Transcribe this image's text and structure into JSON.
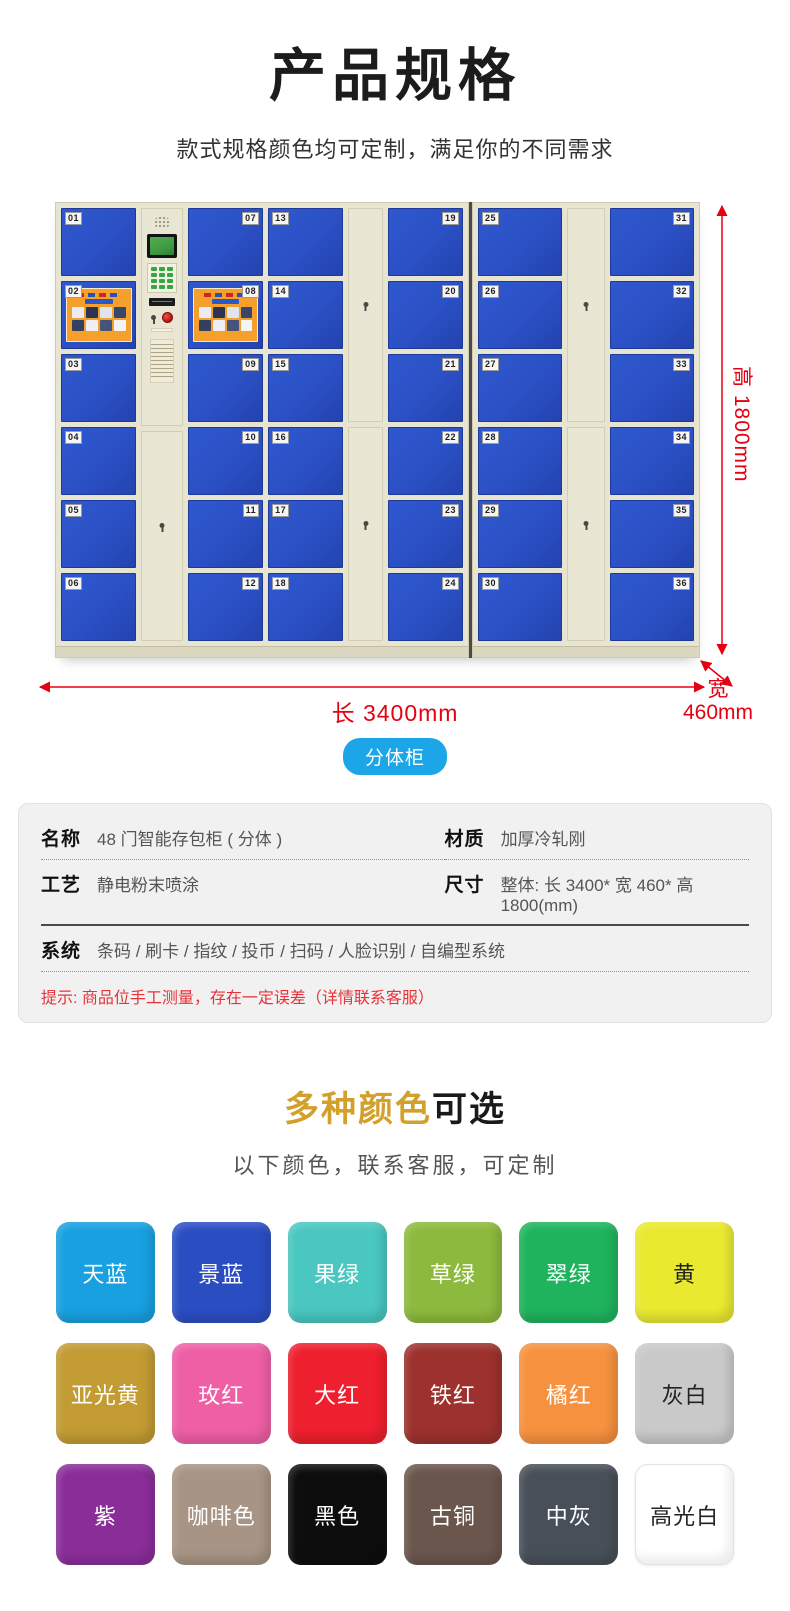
{
  "header": {
    "title": "产品规格",
    "subtitle": "款式规格颜色均可定制，满足你的不同需求"
  },
  "figure": {
    "badge": "分体柜",
    "dim_height": "高 1800mm",
    "dim_length": "长 3400mm",
    "dim_width_top": "宽",
    "dim_width_bottom": "460mm",
    "dim_color": "#e60012",
    "locker": {
      "door_color": "#2b50c5",
      "frame_color": "#e8e4d2",
      "cabinets": [
        {
          "name": "left-cabinet",
          "columns": [
            {
              "type": "doors",
              "numbers": [
                "01",
                "02",
                "03",
                "04",
                "05",
                "06"
              ],
              "num_side": "left",
              "poster_rows": [
                1
              ]
            },
            {
              "type": "control"
            },
            {
              "type": "doors",
              "numbers": [
                "07",
                "08",
                "09",
                "10",
                "11",
                "12"
              ],
              "num_side": "right",
              "poster_rows": [
                1
              ]
            },
            {
              "type": "doors",
              "numbers": [
                "13",
                "14",
                "15",
                "16",
                "17",
                "18"
              ],
              "num_side": "left",
              "poster_rows": []
            },
            {
              "type": "tall"
            },
            {
              "type": "doors",
              "numbers": [
                "19",
                "20",
                "21",
                "22",
                "23",
                "24"
              ],
              "num_side": "right",
              "poster_rows": []
            }
          ]
        },
        {
          "name": "right-cabinet",
          "columns": [
            {
              "type": "doors",
              "numbers": [
                "25",
                "26",
                "27",
                "28",
                "29",
                "30"
              ],
              "num_side": "left",
              "poster_rows": []
            },
            {
              "type": "tall"
            },
            {
              "type": "doors",
              "numbers": [
                "31",
                "32",
                "33",
                "34",
                "35",
                "36"
              ],
              "num_side": "right",
              "poster_rows": []
            }
          ]
        }
      ]
    }
  },
  "specs": {
    "cells": [
      {
        "label": "名称",
        "value": "48 门智能存包柜 ( 分体 )"
      },
      {
        "label": "材质",
        "value": "加厚冷轧刚"
      },
      {
        "label": "工艺",
        "value": "静电粉末喷涂"
      },
      {
        "label": "尺寸",
        "value": "整体: 长 3400* 宽 460* 高 1800(mm)"
      },
      {
        "label": "系统",
        "value": "条码 / 刷卡 / 指纹 / 投币 / 扫码 / 人脸识别 / 自编型系统"
      }
    ],
    "note": "提示: 商品位手工测量，存在一定误差（详情联系客服）"
  },
  "colors_section": {
    "title_highlight": "多种颜色",
    "title_rest": "可选",
    "subtitle": "以下颜色，联系客服，可定制",
    "swatches": [
      {
        "label": "天蓝",
        "bg": "#18a0e0",
        "text": "#ffffff"
      },
      {
        "label": "景蓝",
        "bg": "#2b4dc2",
        "text": "#ffffff"
      },
      {
        "label": "果绿",
        "bg": "#49c7c0",
        "text": "#ffffff"
      },
      {
        "label": "草绿",
        "bg": "#8db93e",
        "text": "#ffffff"
      },
      {
        "label": "翠绿",
        "bg": "#1fb35d",
        "text": "#ffffff"
      },
      {
        "label": "黄",
        "bg": "#e9e930",
        "text": "#222222"
      },
      {
        "label": "亚光黄",
        "bg": "#c29b33",
        "text": "#ffffff"
      },
      {
        "label": "玫红",
        "bg": "#ee5fa5",
        "text": "#ffffff"
      },
      {
        "label": "大红",
        "bg": "#ee1f2e",
        "text": "#ffffff"
      },
      {
        "label": "铁红",
        "bg": "#9c312d",
        "text": "#ffffff"
      },
      {
        "label": "橘红",
        "bg": "#f6913f",
        "text": "#ffffff"
      },
      {
        "label": "灰白",
        "bg": "#c9c9c9",
        "text": "#222222"
      },
      {
        "label": "紫",
        "bg": "#8a2d99",
        "text": "#ffffff"
      },
      {
        "label": "咖啡色",
        "bg": "#a79484",
        "text": "#ffffff"
      },
      {
        "label": "黑色",
        "bg": "#0d0d0d",
        "text": "#ffffff"
      },
      {
        "label": "古铜",
        "bg": "#6b564d",
        "text": "#ffffff"
      },
      {
        "label": "中灰",
        "bg": "#474f58",
        "text": "#ffffff"
      },
      {
        "label": "高光白",
        "bg": "#ffffff",
        "text": "#222222"
      }
    ]
  }
}
